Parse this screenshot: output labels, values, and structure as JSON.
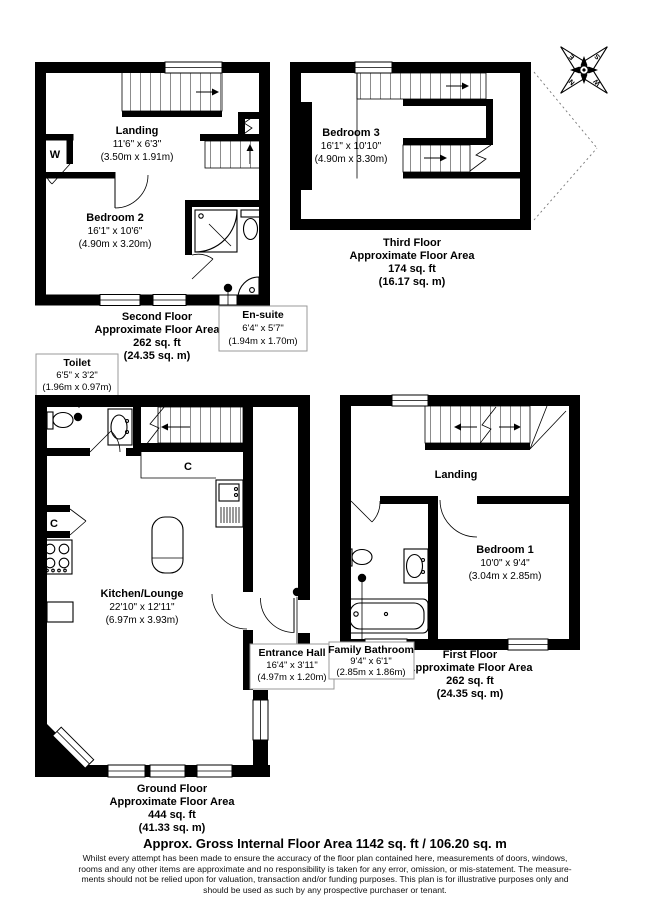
{
  "page": {
    "title": "Approx. Gross Internal Floor Area 1142 sq. ft / 106.20 sq. m",
    "disclaimer": [
      "Whilst every attempt has been made to ensure the accuracy of the floor plan contained here, measurements of doors, windows,",
      "rooms and any other items are approximate and no responsibility is taken for any error, omission, or mis-statement. The measure-",
      "ments should not be relied upon for valuation, transaction and/or funding purposes. This plan is for illustrative purposes only and",
      "should be used as such by any prospective purchaser or tenant."
    ]
  },
  "floors": {
    "second": {
      "title": "Second Floor",
      "area_label": "Approximate Floor Area",
      "area_ft": "262 sq. ft",
      "area_m": "(24.35 sq. m)"
    },
    "third": {
      "title": "Third Floor",
      "area_label": "Approximate Floor Area",
      "area_ft": "174 sq. ft",
      "area_m": "(16.17 sq. m)"
    },
    "ground": {
      "title": "Ground Floor",
      "area_label": "Approximate Floor Area",
      "area_ft": "444 sq. ft",
      "area_m": "(41.33 sq. m)"
    },
    "first": {
      "title": "First Floor",
      "area_label": "Approximate Floor Area",
      "area_ft": "262 sq. ft",
      "area_m": "(24.35 sq. m)"
    }
  },
  "rooms": {
    "landing2": {
      "name": "Landing",
      "imperial": "11'6\" x 6'3\"",
      "metric": "(3.50m x 1.91m)"
    },
    "bedroom2": {
      "name": "Bedroom 2",
      "imperial": "16'1\" x 10'6\"",
      "metric": "(4.90m x 3.20m)"
    },
    "ensuite": {
      "name": "En-suite",
      "imperial": "6'4\" x 5'7\"",
      "metric": "(1.94m x 1.70m)"
    },
    "toilet": {
      "name": "Toilet",
      "imperial": "6'5\" x 3'2\"",
      "metric": "(1.96m x 0.97m)"
    },
    "bedroom3": {
      "name": "Bedroom 3",
      "imperial": "16'1\" x 10'10\"",
      "metric": "(4.90m x 3.30m)"
    },
    "kitchen": {
      "name": "Kitchen/Lounge",
      "imperial": "22'10\" x 12'11\"",
      "metric": "(6.97m x 3.93m)"
    },
    "entrance": {
      "name": "Entrance Hall",
      "imperial": "16'4\" x 3'11\"",
      "metric": "(4.97m x 1.20m)"
    },
    "landing1": {
      "name": "Landing"
    },
    "bedroom1": {
      "name": "Bedroom 1",
      "imperial": "10'0\" x 9'4\"",
      "metric": "(3.04m x 2.85m)"
    },
    "bathroom": {
      "name": "Family Bathroom",
      "imperial": "9'4\" x 6'1\"",
      "metric": "(2.85m x 1.86m)"
    }
  },
  "markers": {
    "wardrobe": "W",
    "cupboard": "C"
  },
  "compass": {
    "n": "N",
    "e": "E",
    "s": "S",
    "w": "W"
  },
  "colors": {
    "wall": "#000000",
    "callout_border": "#999999"
  }
}
